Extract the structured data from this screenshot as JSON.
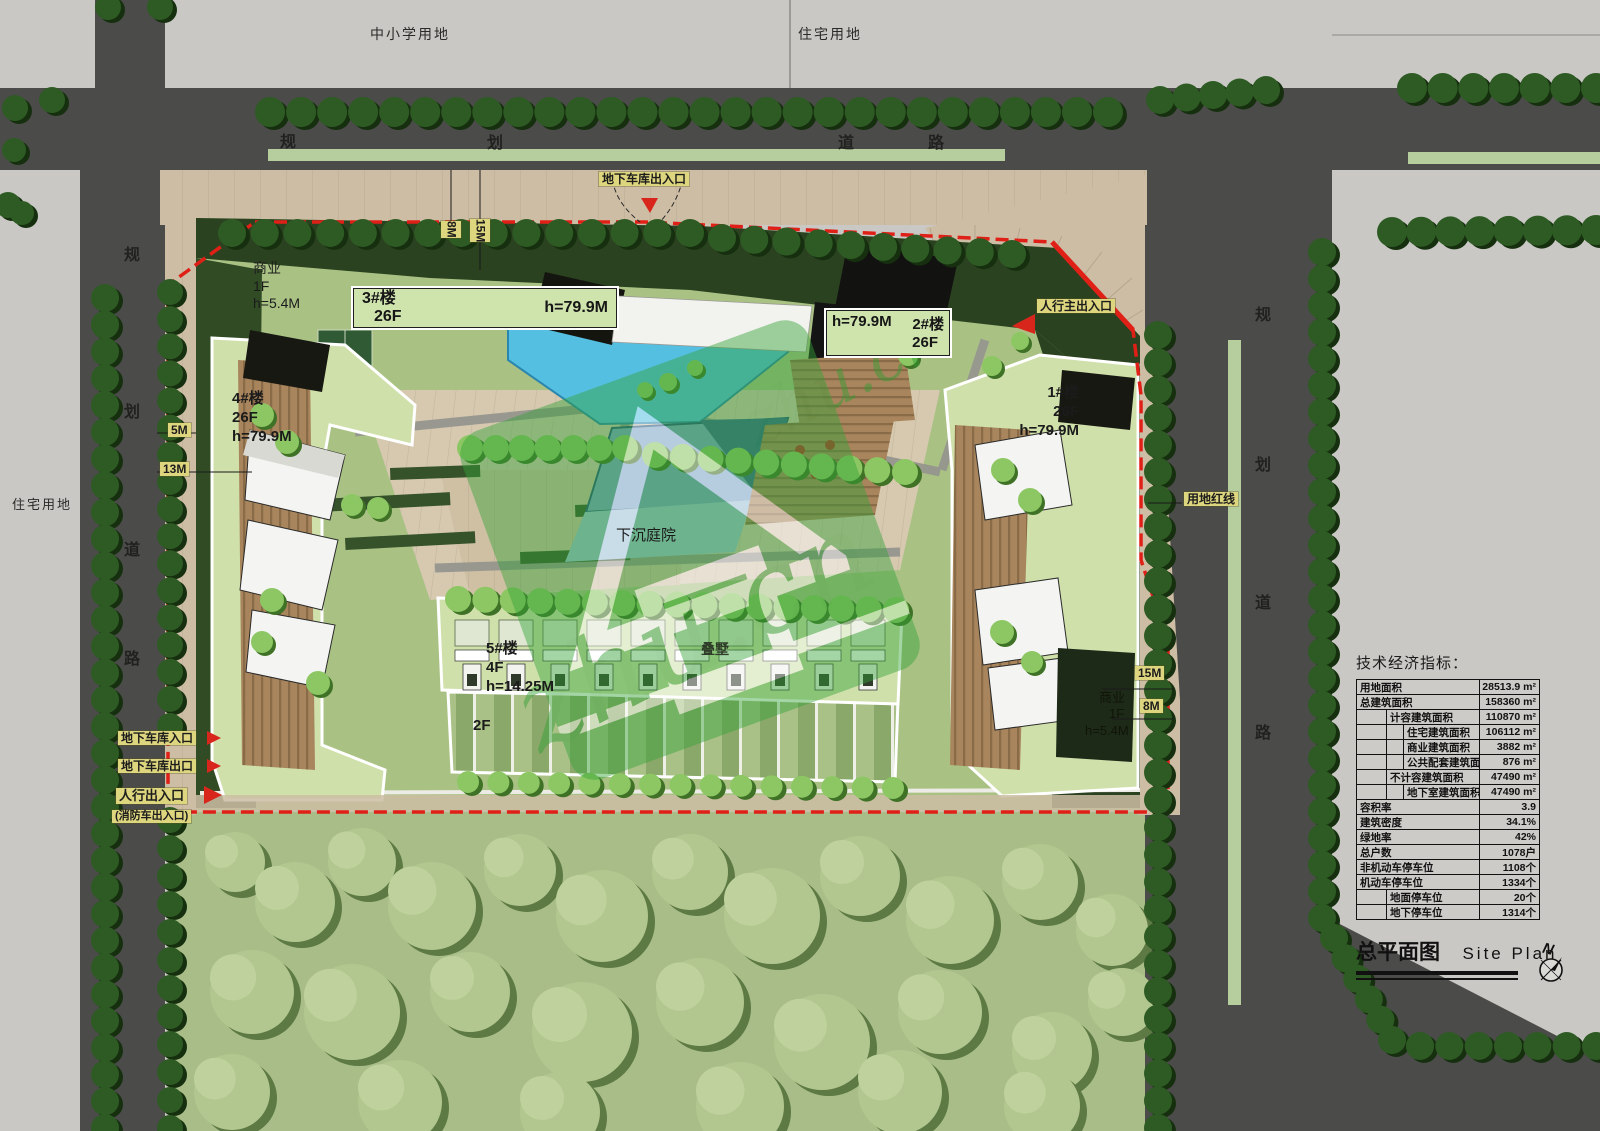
{
  "zones": {
    "school": "中小学用地",
    "residential_top": "住宅用地",
    "residential_left": "住宅用地"
  },
  "road_name_chars": [
    "规",
    "划",
    "道",
    "路"
  ],
  "entrances": {
    "garage_combined": "地下车库出入口",
    "pedestrian_main": "人行主出入口",
    "garage_in": "地下车库入口",
    "garage_out": "地下车库出口",
    "pedestrian": "人行出入口",
    "fire": "(消防车出入口)"
  },
  "dimensions": {
    "top_8m": "8M",
    "top_15m": "15M",
    "left_5m": "5M",
    "left_13m": "13M",
    "right_15m": "15M",
    "right_8m": "8M"
  },
  "boundary_label": "用地红线",
  "buildings": {
    "b1": {
      "name": "1#楼",
      "floors": "26F",
      "height": "h=79.9M"
    },
    "b2": {
      "name": "2#楼",
      "floors": "26F",
      "height": "h=79.9M"
    },
    "b3": {
      "name": "3#楼",
      "floors": "26F",
      "height": "h=79.9M"
    },
    "b4": {
      "name": "4#楼",
      "floors": "26F",
      "height": "h=79.9M"
    },
    "b5": {
      "name": "5#楼",
      "floors": "4F",
      "height": "h=14.25M",
      "wing_floors": "2F",
      "type": "叠墅"
    },
    "commercial_nw": {
      "name": "商业",
      "floors": "1F",
      "height": "h=5.4M"
    },
    "commercial_se": {
      "name": "商业",
      "floors": "1F",
      "height": "h=5.4M"
    }
  },
  "features": {
    "sunken_courtyard": "下沉庭院"
  },
  "eco_table": {
    "title": "技术经济指标：",
    "rows": [
      {
        "label": "用地面积",
        "value": "28513.9 m²"
      },
      {
        "label": "总建筑面积",
        "value": "158360 m²"
      },
      {
        "label": "计容建筑面积",
        "value": "110870 m²"
      },
      {
        "label": "住宅建筑面积",
        "value": "106112 m²"
      },
      {
        "label": "商业建筑面积",
        "value": "3882 m²"
      },
      {
        "label": "公共配套建筑面积",
        "value": "876 m²"
      },
      {
        "label": "不计容建筑面积",
        "value": "47490 m²"
      },
      {
        "label": "地下室建筑面积",
        "value": "47490 m²"
      },
      {
        "label": "容积率",
        "value": "3.9"
      },
      {
        "label": "建筑密度",
        "value": "34.1%"
      },
      {
        "label": "绿地率",
        "value": "42%"
      },
      {
        "label": "总户数",
        "value": "1078户"
      },
      {
        "label": "非机动车停车位",
        "value": "1108个"
      },
      {
        "label": "机动车停车位",
        "value": "1334个"
      },
      {
        "label": "地面停车位",
        "value": "20个"
      },
      {
        "label": "地下停车位",
        "value": "1314个"
      }
    ]
  },
  "title_block": {
    "title_cn": "总平面图",
    "title_en": "Site Plan",
    "compass_n": "N"
  },
  "watermark": {
    "text": "zhu.cn"
  },
  "colors": {
    "boundary_red": "#e02017",
    "label_yellow": "#ded67f",
    "road_gray": "#4b4b49",
    "pool_cyan": "#55bfe2",
    "tree_dark_green": "#2e5b24",
    "lawn_green": "#a9c284",
    "tan_paving": "#cdbda5"
  }
}
